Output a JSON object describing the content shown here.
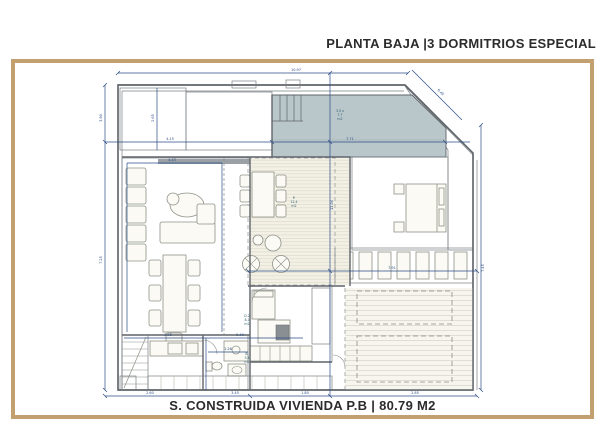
{
  "title": "PLANTA BAJA |3 DORMITRIOS ESPECIAL",
  "caption": "S. CONSTRUIDA VIVIENDA P.B | 80.79 M2",
  "colors": {
    "frame_tan": "#c2a06f",
    "dimension_blue": "#2b4d86",
    "wall_gray": "#5f646a",
    "pool_fill": "#b9c6ca",
    "text_dark": "#2c2c2c"
  },
  "dims": {
    "top": "10.97",
    "diag": "6.45",
    "left_top": "3.90",
    "left_bottom": "7.25",
    "mid_a": "4.15",
    "mid_b": "7.71",
    "width_lower": "7.91",
    "height_full": "11.04",
    "right_side": "7.45",
    "living_width": "4.43",
    "hatch_height": "2.65",
    "kitchen_width": "3.95",
    "kitchen_b": "2.40",
    "bath_h": "1.26",
    "bottom_a": "2.60",
    "bottom_b": "3.45",
    "bottom_c": "1.80",
    "bottom_d": "2.85"
  },
  "tiny_labels": {
    "pool": [
      "3.5 x",
      "7.7",
      "m2"
    ],
    "porch": [
      "P.",
      "12.4",
      "m2"
    ],
    "bedroom": [
      "D.2",
      "8.1",
      "m2"
    ],
    "bath": [
      "B.",
      "3.4",
      "m2"
    ]
  }
}
